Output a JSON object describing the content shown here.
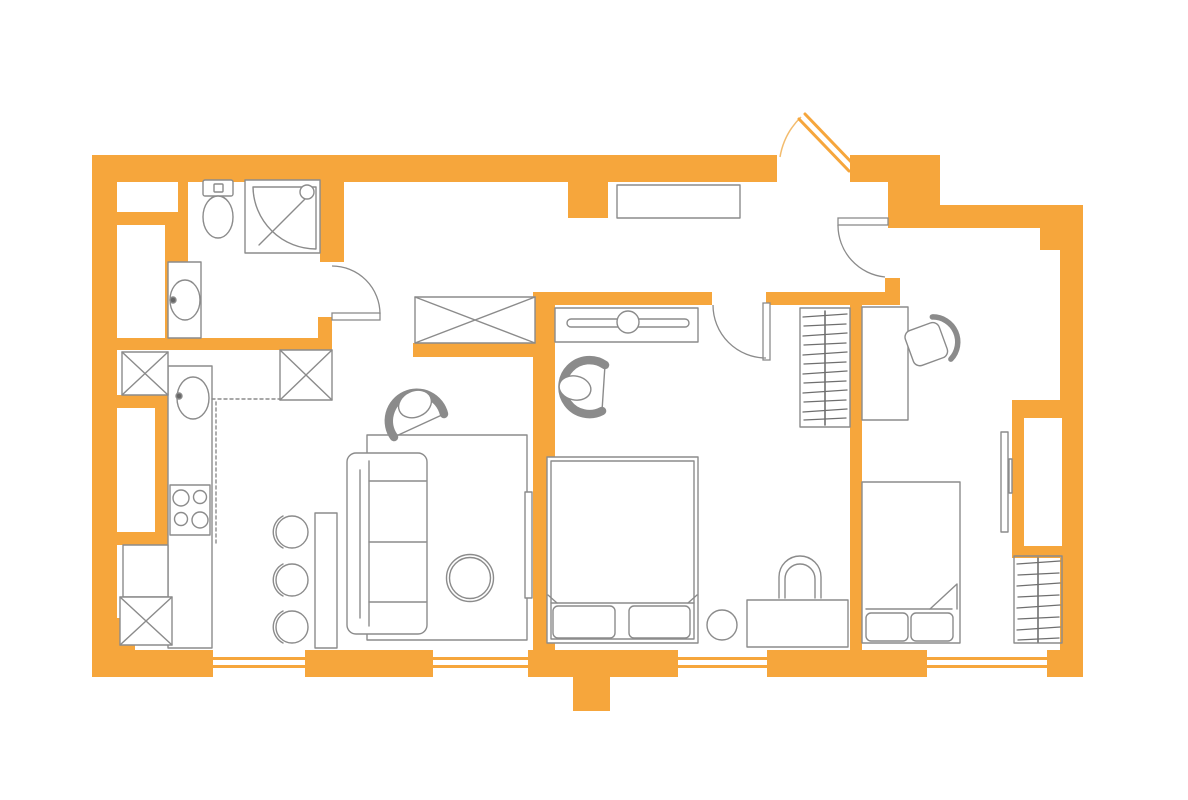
{
  "title": "apartment-floor-plan",
  "canvas": {
    "width": 1188,
    "height": 800
  },
  "colors": {
    "wall": "#F6A63C",
    "wall_arc": "#F3BC6E",
    "line": "#8B8B8B",
    "hatch": "#6F6F6F",
    "dark_dot": "#666666",
    "background": "#FFFFFF",
    "furniture_fill": "#FFFFFF"
  },
  "plan": {
    "type": "one-bedroom-apartment-top-view",
    "window_count": 4,
    "interior_door_count": 3,
    "entrance_door_count": 1,
    "shaft_boxes_crossed": 4,
    "rooms": [
      {
        "name": "bathroom",
        "furniture": [
          "toilet",
          "corner-shower",
          "washbasin"
        ]
      },
      {
        "name": "kitchen",
        "furniture": [
          "counter",
          "sink",
          "stove-4-burners",
          "bar-table",
          "bar-stool",
          "bar-stool",
          "bar-stool",
          "base-cabinet"
        ]
      },
      {
        "name": "living-room",
        "furniture": [
          "rug",
          "sofa",
          "armchair",
          "round-coffee-table",
          "tv-on-wall",
          "built-in-closet"
        ]
      },
      {
        "name": "hallway",
        "furniture": [
          "console-shelf",
          "open-wardrobe-with-hangers"
        ]
      },
      {
        "name": "bedroom",
        "furniture": [
          "double-bed",
          "two-pillows",
          "dresser-with-mirror",
          "armchair",
          "desk",
          "arch-chair",
          "stool"
        ]
      },
      {
        "name": "second-bedroom",
        "furniture": [
          "single-bed",
          "two-pillows",
          "desk",
          "office-chair",
          "tv-on-wall",
          "wardrobe-niche",
          "clothes-rack-with-hangers"
        ]
      }
    ]
  }
}
